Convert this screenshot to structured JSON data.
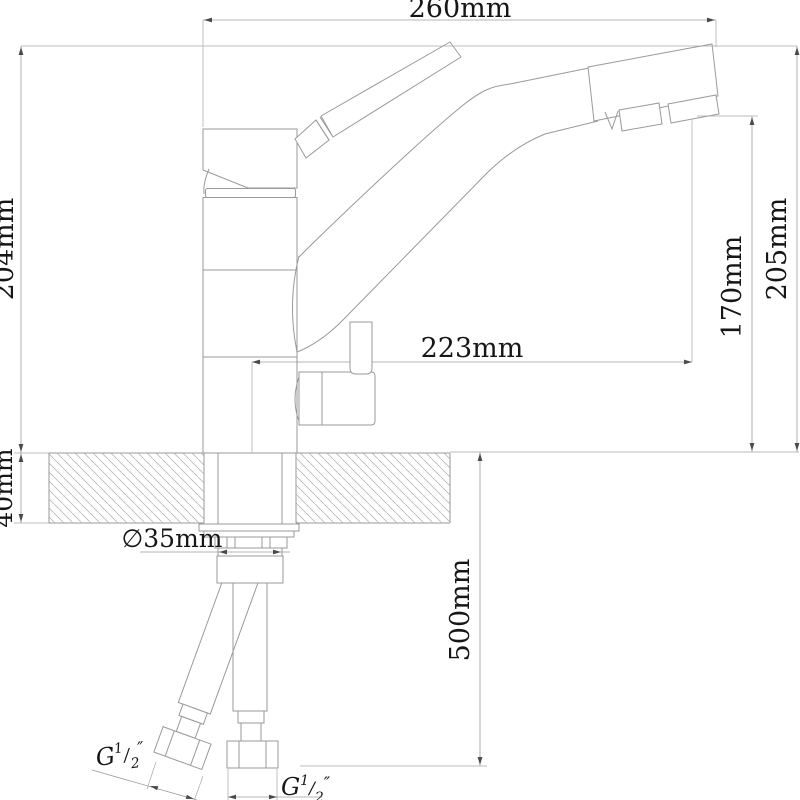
{
  "drawing": {
    "dimensions": {
      "spout_reach": "260mm",
      "height_to_top": "204mm",
      "overall_height": "205mm",
      "outlet_height": "170mm",
      "spout_tip_offset": "223mm",
      "deck_thickness": "40mm",
      "shank_diameter": "∅35mm",
      "hose_length": "500mm"
    },
    "thread_labels": {
      "left": {
        "prefix": "G",
        "numerator": "1",
        "slash": "/",
        "denominator": "2",
        "unit": "″"
      },
      "right": {
        "prefix": "G",
        "numerator": "1",
        "slash": "/",
        "denominator": "2",
        "unit": "″"
      }
    }
  }
}
